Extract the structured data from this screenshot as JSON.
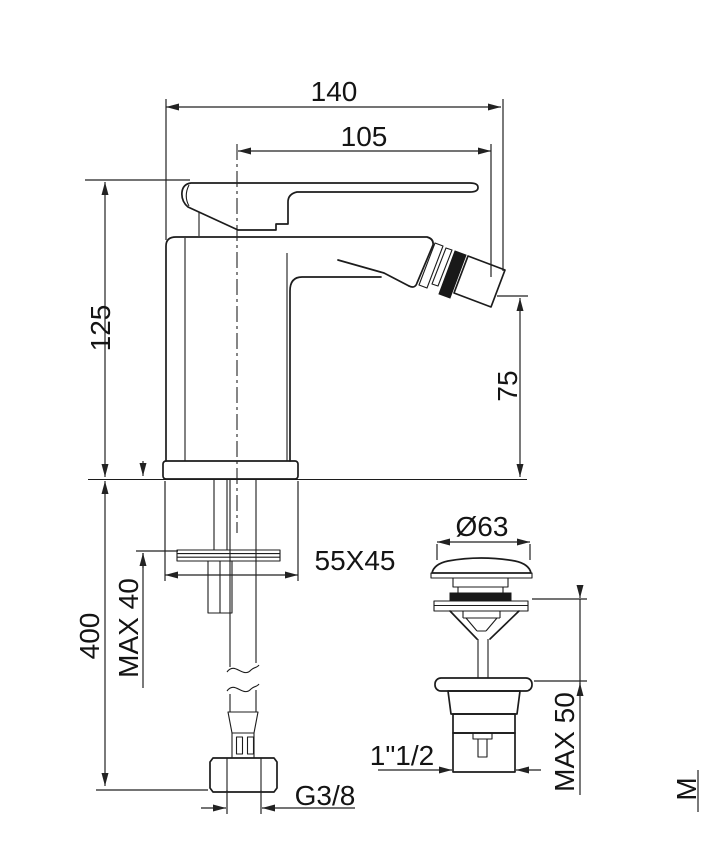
{
  "drawing": {
    "type": "technical-dimension-drawing",
    "subject": "single-lever bidet mixer with flexible supply hose and pop-up waste detail",
    "colors": {
      "line": "#1c1c1c",
      "background": "#ffffff"
    },
    "views": {
      "main_view": "bidet-mixer-side-view",
      "detail_view": "pop-up-waste-detail"
    },
    "dimensions": {
      "projection_total": "140",
      "projection_spout": "105",
      "height_body": "125",
      "height_spout": "75",
      "base_footprint": "55X45",
      "max_deck_thickness": "MAX 40",
      "hose_length": "400",
      "hose_thread": "G3/8",
      "waste_body_thread": "1\"1/2",
      "waste_cap_diameter": "Ø63",
      "waste_max_deck": "MAX 50",
      "edge_partial_label": "M"
    }
  }
}
